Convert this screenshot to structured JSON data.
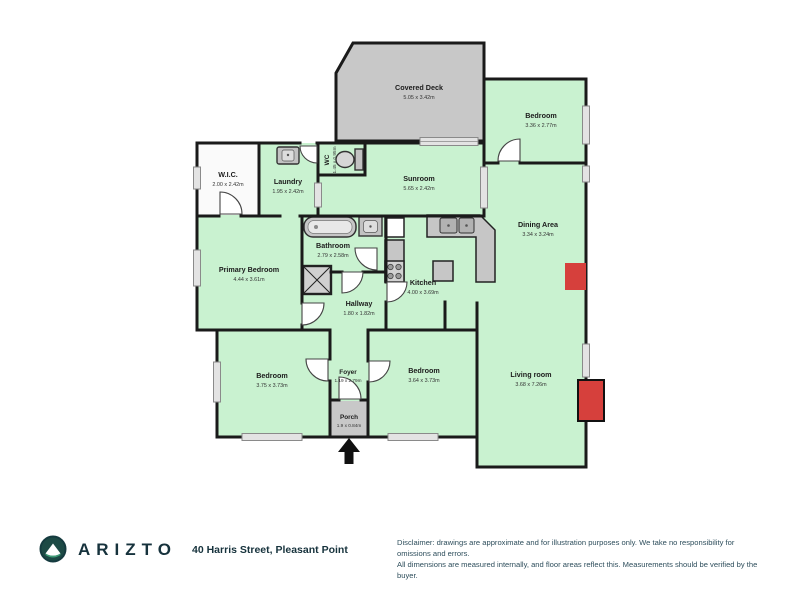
{
  "floorplan": {
    "rooms": [
      {
        "name": "Covered Deck",
        "dims": "5.05 x 3.42m"
      },
      {
        "name": "Bedroom",
        "dims": "3.36 x 2.77m"
      },
      {
        "name": "W.I.C.",
        "dims": "2.00 x 2.42m"
      },
      {
        "name": "Laundry",
        "dims": "1.95 x 2.42m"
      },
      {
        "name": "WC",
        "dims": "1.45 x 0.95m"
      },
      {
        "name": "Sunroom",
        "dims": "5.65 x 2.42m"
      },
      {
        "name": "Dining Area",
        "dims": "3.34 x 3.24m"
      },
      {
        "name": "Primary Bedroom",
        "dims": "4.44 x 3.61m"
      },
      {
        "name": "Bathroom",
        "dims": "2.79 x 2.58m"
      },
      {
        "name": "Kitchen",
        "dims": "4.00 x 3.69m"
      },
      {
        "name": "Hallway",
        "dims": "1.80 x 1.82m"
      },
      {
        "name": "Bedroom",
        "dims": "3.75 x 3.73m"
      },
      {
        "name": "Foyer",
        "dims": "1.19 x 2.79m"
      },
      {
        "name": "Bedroom",
        "dims": "3.64 x 3.73m"
      },
      {
        "name": "Living room",
        "dims": "3.68 x 7.26m"
      },
      {
        "name": "Porch",
        "dims": "1.9 x 0.84m"
      }
    ],
    "colors": {
      "room_green": "#c9f2d0",
      "deck_gray": "#c8c8c8",
      "wall_black": "#1a1a1a",
      "fireplace_red": "#d6403c",
      "wic_white": "#fafafa"
    }
  },
  "footer": {
    "brand": "ARIZTO",
    "address": "40 Harris Street, Pleasant Point",
    "disclaimer_line1": "Disclaimer: drawings are approximate and for illustration purposes only. We take no responsibility for omissions and errors.",
    "disclaimer_line2": "All dimensions are measured internally, and floor areas reflect this. Measurements should be verified by the buyer."
  }
}
